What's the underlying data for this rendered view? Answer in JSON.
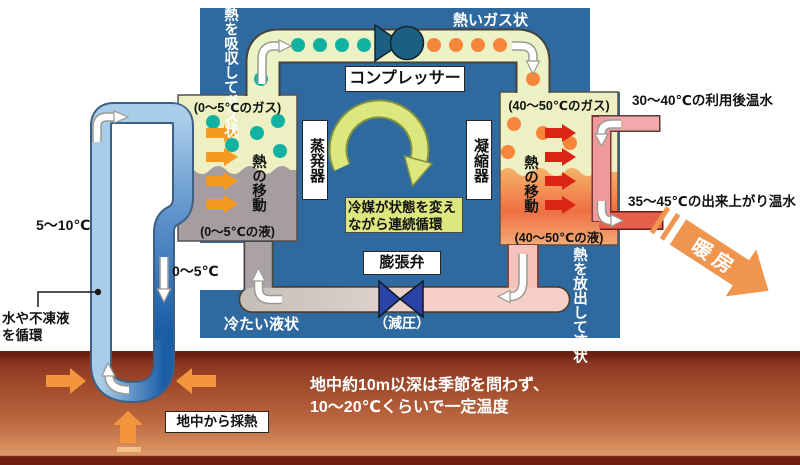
{
  "unit": {
    "compressor": "コンプレッサー",
    "evaporator": "蒸発器",
    "condenser": "凝縮器",
    "expansion_valve": "膨張弁",
    "decompression": "（減圧）",
    "hot_gas": "熱いガス状",
    "cold_liquid": "冷たい液状",
    "absorb_heat": "熱を吸収してガス状",
    "release_heat": "熱を放出して液状",
    "refrigerant_cycle": "冷媒が状態を変えながら連続循環",
    "evap_gas": "(0～5℃のガス)",
    "evap_liquid": "(0～5℃の液)",
    "evap_heat_transfer": "熱の移動",
    "cond_gas": "(40～50℃のガス)",
    "cond_liquid": "(40～50℃の液)",
    "cond_heat_transfer": "熱の移動"
  },
  "ground_loop": {
    "up_temp": "5～10℃",
    "down_temp": "0～5℃",
    "circulation": "水や不凍液を循環",
    "heat_collection": "地中から採熱"
  },
  "water_loop": {
    "return_water": "30～40℃の利用後温水",
    "supply_water": "35～45℃の出来上がり温水",
    "heating": "暖房"
  },
  "ground": {
    "note_line1": "地中約10m以深は季節を問わず、",
    "note_line2": "10～20℃くらいで一定温度"
  },
  "colors": {
    "unit_blue": "#2e6a9f",
    "pipe_green": "#edf2c6",
    "teal_dot": "#12b2a2",
    "orange_dot": "#f5863c",
    "ground_pipe_blue": "#a9cce9",
    "warm_pipe_pink": "#f2a9ab",
    "hot_pipe_red": "#e4604b",
    "heating_orange": "#f0954e"
  }
}
